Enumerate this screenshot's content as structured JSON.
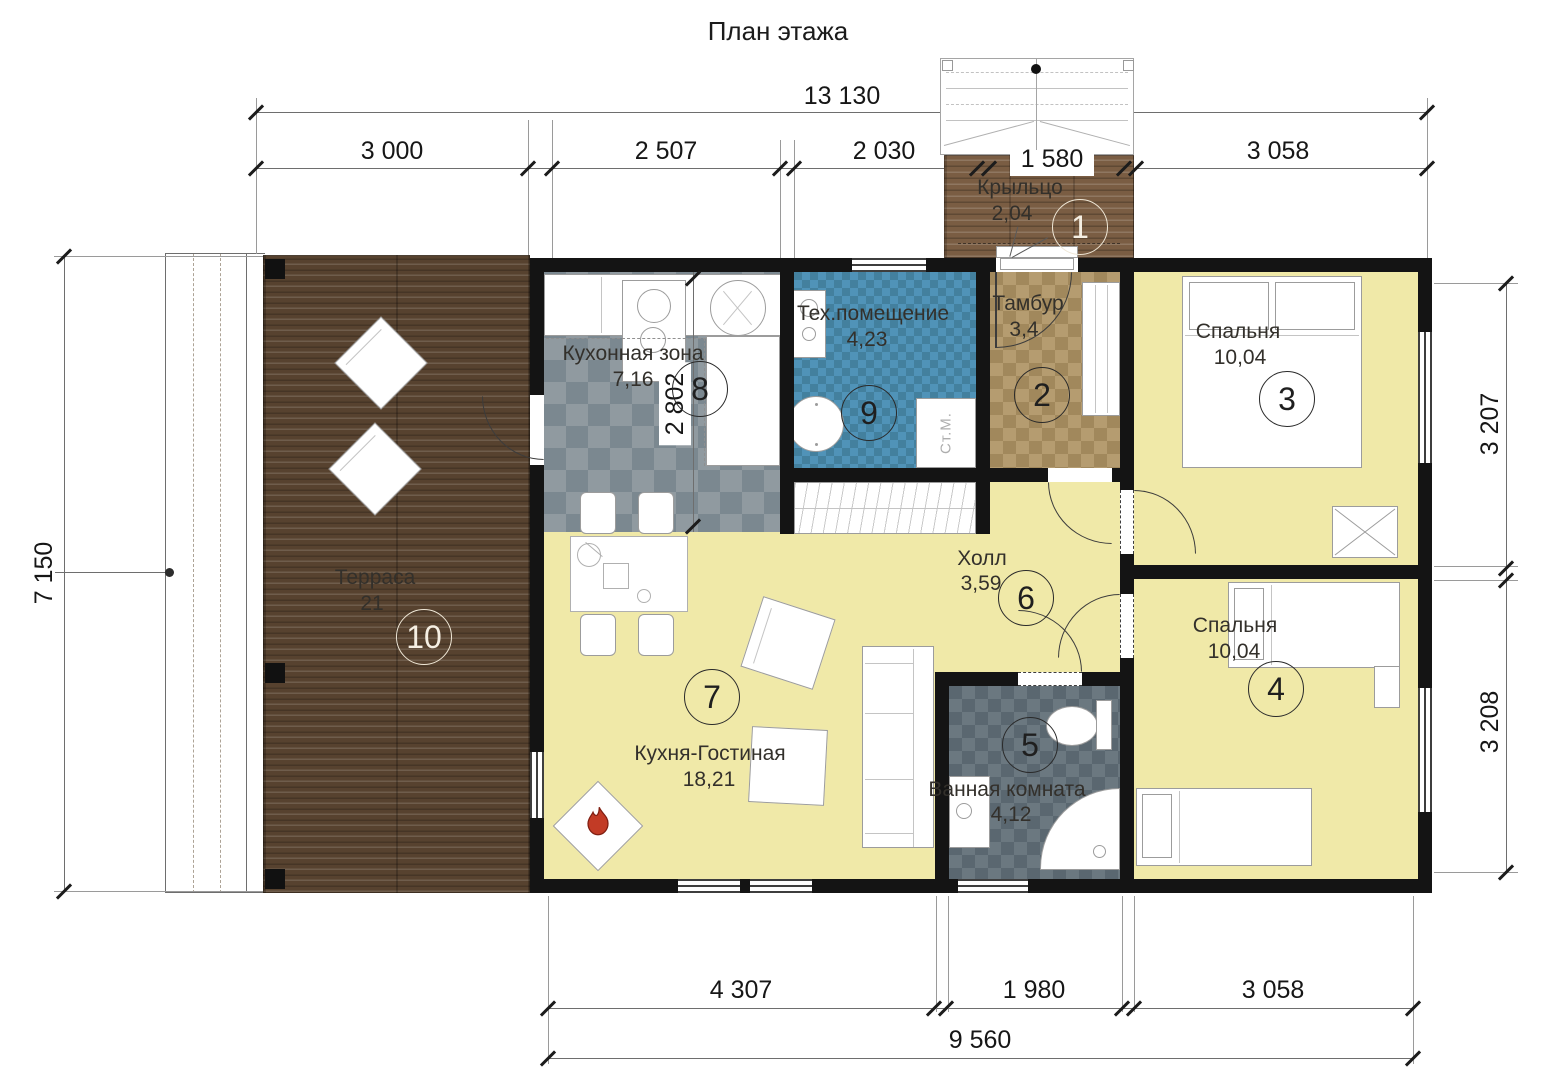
{
  "title": "План этажа",
  "dims": {
    "top_total": "13 130",
    "top_segments": [
      "3 000",
      "2 507",
      "2 030",
      "1 580",
      "3 058"
    ],
    "left_total": "7 150",
    "right_top": "3 207",
    "right_bottom": "3 208",
    "kitchen_depth": "2 802",
    "bottom_segments": [
      "4 307",
      "1 980",
      "3 058"
    ],
    "bottom_total": "9 560"
  },
  "rooms": {
    "porch": {
      "num": "1",
      "name": "Крыльцо",
      "area": "2,04"
    },
    "tambur": {
      "num": "2",
      "name": "Тамбур",
      "area": "3,4"
    },
    "bedroom1": {
      "num": "3",
      "name": "Спальня",
      "area": "10,04"
    },
    "bedroom2": {
      "num": "4",
      "name": "Спальня",
      "area": "10,04"
    },
    "bathroom": {
      "num": "5",
      "name": "Ванная комната",
      "area": "4,12"
    },
    "hall": {
      "num": "6",
      "name": "Холл",
      "area": "3,59"
    },
    "living": {
      "num": "7",
      "name": "Кухня-Гостиная",
      "area": "18,21"
    },
    "kitchen": {
      "num": "8",
      "name": "Кухонная зона",
      "area": "7,16"
    },
    "tech": {
      "num": "9",
      "name": "Тех.помещение",
      "area": "4,23"
    },
    "terrace": {
      "num": "10",
      "name": "Терраса",
      "area": "21"
    }
  },
  "labels": {
    "washing_machine": "Ст.М."
  },
  "colors": {
    "wall": "#141414",
    "room_floor": "#f0e9a8",
    "terrace_wood": "#57422f",
    "porch_wood": "#7a5d43",
    "kitchen_tile": "#89949b",
    "tech_tile": "#4d90b4",
    "tambur_tile": "#ad9468",
    "bath_tile": "#65727a",
    "flame": "#c23b26"
  }
}
